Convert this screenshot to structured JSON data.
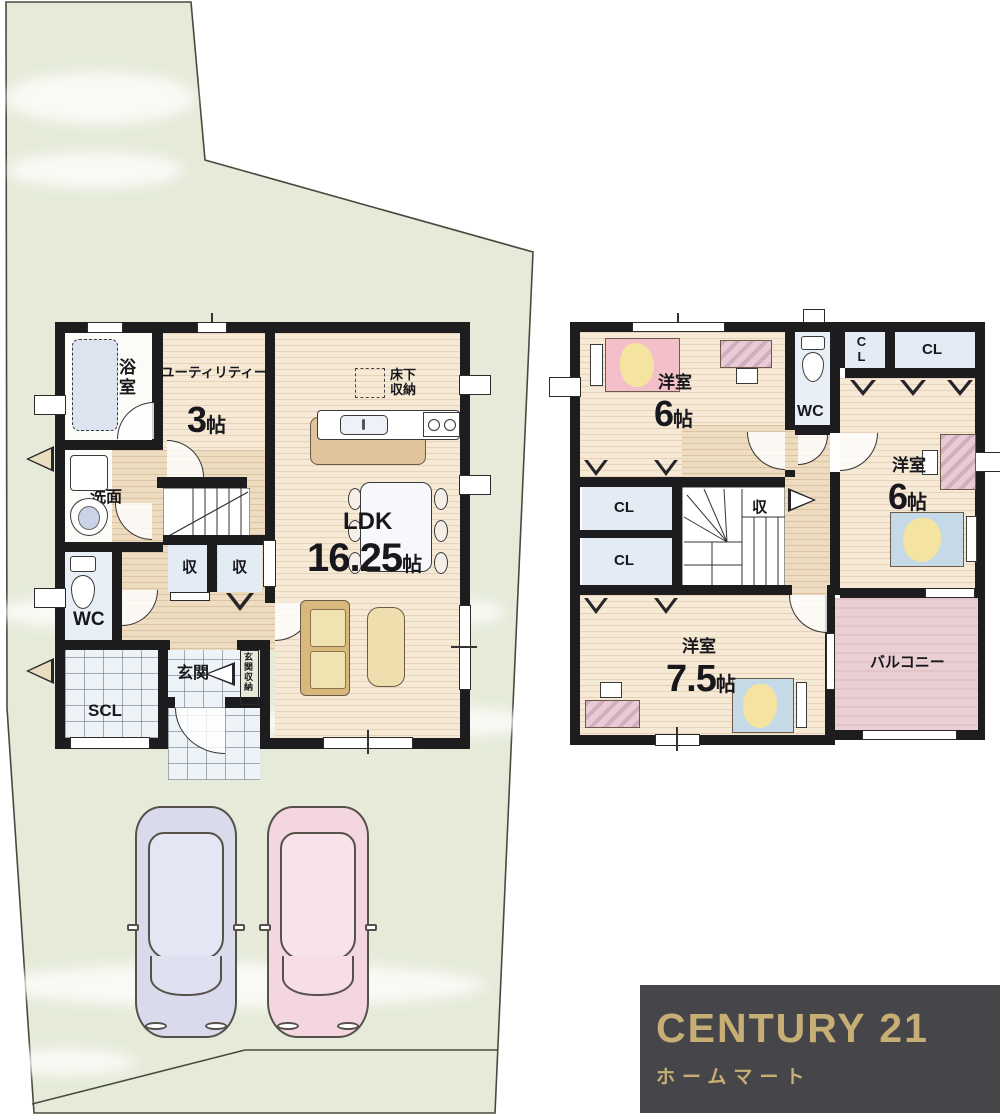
{
  "floor1": {
    "bath": "浴室",
    "utility": "ユーティリティー",
    "utility_num": "3",
    "utility_unit": "帖",
    "washroom": "洗面",
    "wc": "WC",
    "closet_a": "収",
    "closet_b": "収",
    "entrance": "玄関",
    "entrance_storage": "玄関収納",
    "scl": "SCL",
    "ldk": "LDK",
    "ldk_num": "16.25",
    "ldk_unit": "帖",
    "underfloor_1": "床下",
    "underfloor_2": "収納"
  },
  "floor2": {
    "room1": "洋室",
    "room1_num": "6",
    "room1_unit": "帖",
    "wc": "WC",
    "cl_small": "CL",
    "cl_top": "CL",
    "room2": "洋室",
    "room2_num": "6",
    "room2_unit": "帖",
    "cl_mid": "CL",
    "cl_low": "CL",
    "storage": "収",
    "room3": "洋室",
    "room3_num": "7.5",
    "room3_unit": "帖",
    "balcony": "バルコニー"
  },
  "logo": {
    "brand": "CENTURY 21",
    "subtitle": "ホームマート"
  },
  "palette": {
    "lot_fill": "#e6ebd9",
    "wall": "#1d1d1f",
    "wood_floor": "#f6ead7",
    "hall_floor": "#eddcc0",
    "closet_floor": "#e3ebf4",
    "tile_floor": "#eef3f8",
    "balcony_floor": "#ead0d4",
    "logo_bg": "#46464a",
    "logo_gold": "#c7ae74",
    "car_left": "#d9dbec",
    "car_right": "#f4d6e0"
  }
}
